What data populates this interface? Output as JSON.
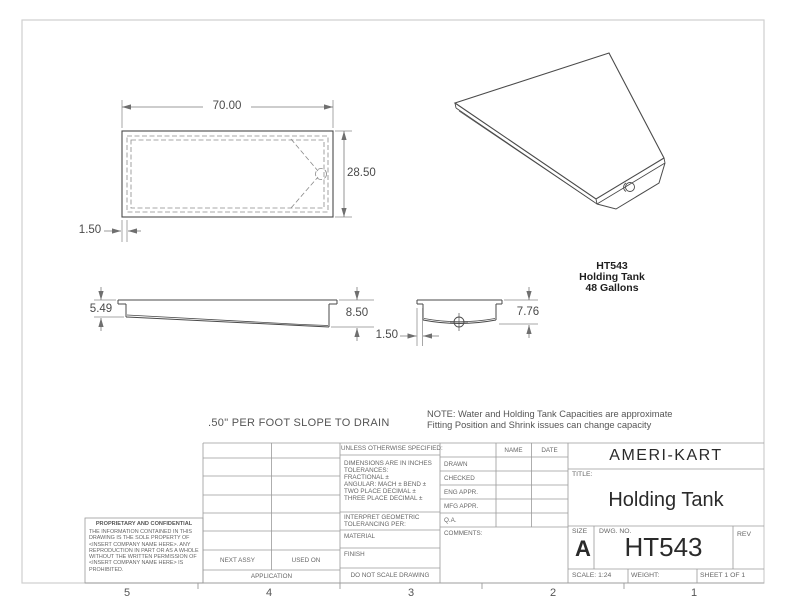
{
  "views": {
    "top": {
      "dim_width": "70.00",
      "dim_height": "28.50",
      "dim_flange": "1.50"
    },
    "front": {
      "dim_left_depth": "5.49",
      "dim_right_depth": "8.50"
    },
    "end": {
      "dim_depth": "7.76",
      "dim_flange": "1.50"
    }
  },
  "part_label": {
    "model": "HT543",
    "name": "Holding Tank",
    "capacity": "48 Gallons"
  },
  "notes": {
    "slope": ".50\" PER FOOT SLOPE TO DRAIN",
    "capacity_line1": "NOTE: Water and Holding Tank Capacities are approximate",
    "capacity_line2": "Fitting Position and Shrink issues can change capacity"
  },
  "title_block": {
    "company": "AMERI-KART",
    "title_label": "TITLE:",
    "title": "Holding Tank",
    "size_label": "SIZE",
    "size": "A",
    "dwg_label": "DWG.  NO.",
    "dwg_no": "HT543",
    "rev_label": "REV",
    "scale": "SCALE: 1:24",
    "weight_label": "WEIGHT:",
    "sheet": "SHEET 1 OF 1",
    "approvals": {
      "name_header": "NAME",
      "date_header": "DATE",
      "rows": [
        "DRAWN",
        "CHECKED",
        "ENG APPR.",
        "MFG APPR.",
        "Q.A."
      ],
      "comments_label": "COMMENTS:"
    },
    "tolerance": {
      "header": "UNLESS OTHERWISE SPECIFIED:",
      "lines": [
        "DIMENSIONS ARE IN INCHES",
        "TOLERANCES:",
        "FRACTIONAL ±",
        "ANGULAR: MACH ±   BEND ±",
        "TWO PLACE DECIMAL    ±",
        "THREE PLACE DECIMAL  ±"
      ],
      "interpret_line1": "INTERPRET GEOMETRIC",
      "interpret_line2": "TOLERANCING PER:",
      "material_label": "MATERIAL",
      "finish_label": "FINISH",
      "do_not_scale": "DO NOT SCALE DRAWING"
    },
    "application": {
      "next_assy": "NEXT ASSY",
      "used_on": "USED ON",
      "application_label": "APPLICATION"
    },
    "proprietary": {
      "header": "PROPRIETARY AND CONFIDENTIAL",
      "body": "THE INFORMATION CONTAINED IN THIS DRAWING IS THE SOLE PROPERTY OF <INSERT COMPANY NAME HERE>.  ANY REPRODUCTION IN PART OR AS A WHOLE WITHOUT THE WRITTEN PERMISSION OF <INSERT COMPANY NAME HERE> IS PROHIBITED."
    }
  },
  "zones": {
    "bottom": [
      "5",
      "4",
      "3",
      "2",
      "1"
    ]
  }
}
